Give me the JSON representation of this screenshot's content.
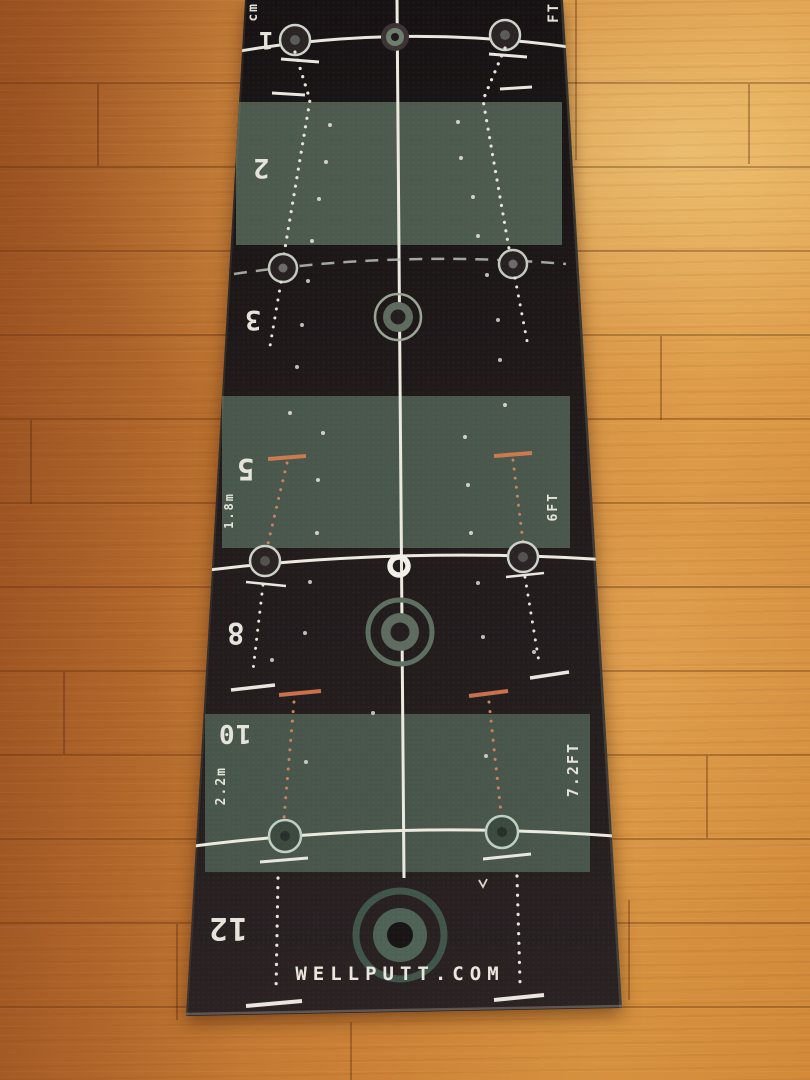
{
  "mat": {
    "brand": "WELLPUTT.COM",
    "top_units": {
      "left": "cm",
      "right": "FT"
    },
    "sections": [
      {
        "number": "1"
      },
      {
        "number": "2"
      },
      {
        "number": "3"
      },
      {
        "number": "5",
        "metric": "1.8m",
        "imperial": "6FT"
      },
      {
        "number": "8"
      },
      {
        "number": "10",
        "metric": "2.2m",
        "imperial": "7.2FT"
      },
      {
        "number": "12"
      }
    ]
  },
  "colors": {
    "mat_black": "#211a1b",
    "panel_green": "#4b584d",
    "line_white": "#eceadf",
    "accent_orange": "#c97a50",
    "target_sage": "#5d6c5e",
    "target_dark_ring": "#41564a",
    "floor_orange": "#c67c34"
  }
}
